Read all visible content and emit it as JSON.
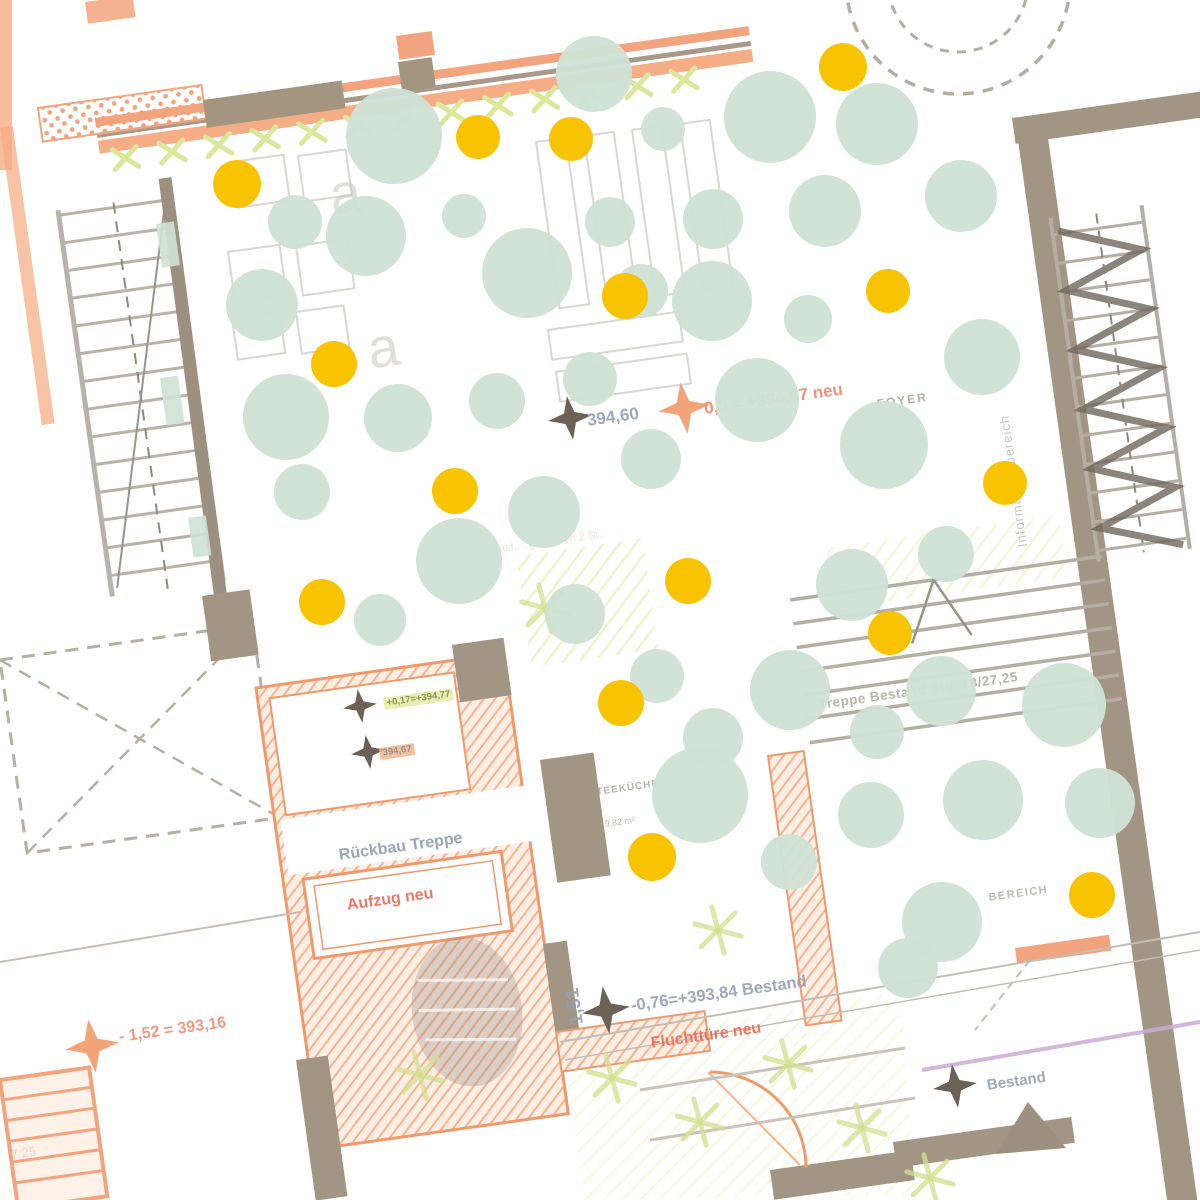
{
  "scene": {
    "description": "Architectural floor plan (rotated ~-8deg) with overlay of mint and yellow dots",
    "plan_rotation_deg": -8,
    "background": "#ffffff"
  },
  "colors": {
    "mint_bubble": "#cfe2d4",
    "yellow_bubble": "#f8c300",
    "wall_taupe": "#a29584",
    "wall_orange": "#f2a47e",
    "orange_hatch": "#f6b391",
    "lime": "#dbe79b",
    "blue_gray_text": "#93a0b4",
    "orange_text": "#f0876a",
    "red_orange_text": "#ea6a55",
    "warm_gray_text": "#a7a29a",
    "violet_line": "#cbaad6",
    "marker_dark": "#6b6157",
    "marker_orange": "#f2a478"
  },
  "labels": [
    {
      "id": "level-394-60",
      "text": "394,60",
      "x": 586,
      "y": 412,
      "size": 17,
      "color": "#93a0b4",
      "bold": true,
      "rot": -8,
      "op": 0.9
    },
    {
      "id": "level-394-67-neu",
      "text": "0,0 = +394,67 neu",
      "x": 703,
      "y": 400,
      "size": 17,
      "color": "#f0876a",
      "bold": true,
      "rot": -8,
      "op": 0.9
    },
    {
      "id": "room-foyer",
      "text": "FOYER",
      "x": 876,
      "y": 398,
      "size": 12,
      "color": "#a7a29a",
      "bold": true,
      "rot": -8,
      "ls": 2,
      "op": 0.85
    },
    {
      "id": "zone-informationsbereich",
      "text": "Informationsbereich",
      "x": 1016,
      "y": 548,
      "size": 13,
      "color": "#a7a29a",
      "rot": -98,
      "ls": 1,
      "op": 0.6
    },
    {
      "id": "note-rueckbau-treppe",
      "text": "Rückbau Treppe",
      "x": 338,
      "y": 848,
      "size": 16,
      "color": "#8e9db3",
      "bold": true,
      "rot": -8,
      "op": 0.9
    },
    {
      "id": "note-aufzug-neu",
      "text": "Aufzug neu",
      "x": 346,
      "y": 898,
      "size": 16,
      "color": "#ea6a55",
      "bold": true,
      "rot": -8,
      "op": 0.9
    },
    {
      "id": "level-394-77",
      "text": "+0,17=+394,77",
      "x": 383,
      "y": 698,
      "size": 9.5,
      "color": "#7d8746",
      "bold": true,
      "rot": -8,
      "bg": "#e7eeab",
      "op": 0.9
    },
    {
      "id": "level-394-67-chip",
      "text": "394,67",
      "x": 379,
      "y": 748,
      "size": 9.5,
      "color": "#857f76",
      "bold": true,
      "rot": -8,
      "bg": "#f3b48f",
      "op": 0.85
    },
    {
      "id": "room-teekueche",
      "text": "TEEKÜCHE",
      "x": 596,
      "y": 788,
      "size": 10,
      "color": "#a7a29a",
      "bold": true,
      "rot": -8,
      "ls": 1,
      "op": 0.8
    },
    {
      "id": "room-teekueche-area",
      "text": "9,82 m²",
      "x": 604,
      "y": 820,
      "size": 9,
      "color": "#a7a29a",
      "rot": -8,
      "op": 0.75
    },
    {
      "id": "note-treppe-bestand",
      "text": "Treppe Bestand Stg. 18/27,25",
      "x": 818,
      "y": 698,
      "size": 13.5,
      "color": "#a7a29a",
      "bold": true,
      "rot": -8,
      "ls": 0.5,
      "op": 0.8
    },
    {
      "id": "zone-bereich",
      "text": "BEREICH",
      "x": 988,
      "y": 893,
      "size": 11,
      "color": "#a7a29a",
      "bold": true,
      "rot": -8,
      "ls": 1.5,
      "op": 0.75
    },
    {
      "id": "level-393-84",
      "text": "-0,76=+393,84 Bestand",
      "x": 630,
      "y": 998,
      "size": 16.5,
      "color": "#93a0b4",
      "bold": true,
      "rot": -8,
      "op": 0.9
    },
    {
      "id": "dim-1-51",
      "text": "1,51",
      "x": 568,
      "y": 1026,
      "size": 19,
      "color": "#93a0b4",
      "bold": true,
      "rot": -98,
      "op": 0.9
    },
    {
      "id": "note-fluchttuere",
      "text": "Fluchttüre neu",
      "x": 650,
      "y": 1036,
      "size": 16,
      "color": "#ea6a55",
      "bold": true,
      "rot": -8,
      "op": 0.9
    },
    {
      "id": "level-393-16",
      "text": "- 1,52 = 393,16",
      "x": 118,
      "y": 1030,
      "size": 16,
      "color": "#f0876a",
      "bold": true,
      "rot": -8,
      "op": 0.85
    },
    {
      "id": "note-bestand",
      "text": "Bestand",
      "x": 986,
      "y": 1078,
      "size": 15,
      "color": "#93a0b4",
      "bold": true,
      "rot": -8,
      "op": 0.9
    },
    {
      "id": "faint-note",
      "text": "e Tast.. ..geblieben 2 St..",
      "x": 484,
      "y": 546,
      "size": 11,
      "color": "#f0876a",
      "rot": -8,
      "op": 0.3
    },
    {
      "id": "furniture-a-1",
      "text": "a",
      "x": 326,
      "y": 168,
      "size": 56,
      "color": "#c9c5bf",
      "rot": -8,
      "op": 0.55
    },
    {
      "id": "furniture-a-2",
      "text": "a",
      "x": 364,
      "y": 322,
      "size": 56,
      "color": "#c9c5bf",
      "rot": -8,
      "op": 0.55
    },
    {
      "id": "stair-dim",
      "text": "7 25",
      "x": 10,
      "y": 1148,
      "size": 13,
      "color": "#f0876a",
      "rot": -8,
      "op": 0.3
    }
  ],
  "markers": [
    {
      "x": 570,
      "y": 418,
      "color": "#6b6157",
      "size": 22
    },
    {
      "x": 684,
      "y": 408,
      "color": "#f2a478",
      "size": 26
    },
    {
      "x": 360,
      "y": 706,
      "color": "#6b6157",
      "size": 17
    },
    {
      "x": 368,
      "y": 752,
      "color": "#6b6157",
      "size": 17
    },
    {
      "x": 606,
      "y": 1010,
      "color": "#6b6157",
      "size": 24
    },
    {
      "x": 92,
      "y": 1046,
      "color": "#f2a478",
      "size": 27
    },
    {
      "x": 955,
      "y": 1086,
      "color": "#6b6157",
      "size": 22
    }
  ],
  "bubbles": {
    "mint": [
      [
        594,
        74,
        38
      ],
      [
        663,
        129,
        22
      ],
      [
        770,
        117,
        46
      ],
      [
        877,
        124,
        41
      ],
      [
        394,
        136,
        48
      ],
      [
        961,
        196,
        36
      ],
      [
        825,
        211,
        36
      ],
      [
        713,
        219,
        30
      ],
      [
        610,
        222,
        25
      ],
      [
        464,
        216,
        22
      ],
      [
        295,
        222,
        27
      ],
      [
        366,
        236,
        40
      ],
      [
        527,
        273,
        45
      ],
      [
        641,
        291,
        27
      ],
      [
        712,
        301,
        40
      ],
      [
        808,
        319,
        24
      ],
      [
        262,
        305,
        36
      ],
      [
        982,
        357,
        38
      ],
      [
        286,
        417,
        43
      ],
      [
        398,
        418,
        34
      ],
      [
        497,
        401,
        28
      ],
      [
        590,
        379,
        27
      ],
      [
        757,
        400,
        42
      ],
      [
        884,
        445,
        44
      ],
      [
        302,
        492,
        28
      ],
      [
        651,
        459,
        30
      ],
      [
        544,
        512,
        36
      ],
      [
        459,
        561,
        43
      ],
      [
        946,
        554,
        28
      ],
      [
        852,
        585,
        36
      ],
      [
        575,
        614,
        30
      ],
      [
        380,
        620,
        26
      ],
      [
        657,
        676,
        27
      ],
      [
        790,
        690,
        40
      ],
      [
        941,
        691,
        35
      ],
      [
        1064,
        705,
        42
      ],
      [
        713,
        738,
        30
      ],
      [
        877,
        732,
        27
      ],
      [
        700,
        795,
        48
      ],
      [
        983,
        800,
        40
      ],
      [
        1100,
        803,
        35
      ],
      [
        871,
        815,
        33
      ],
      [
        789,
        862,
        28
      ],
      [
        942,
        922,
        40
      ],
      [
        908,
        968,
        30
      ]
    ],
    "yellow": [
      [
        843,
        67,
        24
      ],
      [
        478,
        137,
        22
      ],
      [
        571,
        139,
        22
      ],
      [
        237,
        184,
        24
      ],
      [
        625,
        296,
        23
      ],
      [
        888,
        291,
        22
      ],
      [
        334,
        364,
        23
      ],
      [
        455,
        491,
        23
      ],
      [
        1005,
        483,
        22
      ],
      [
        322,
        602,
        23
      ],
      [
        688,
        581,
        23
      ],
      [
        890,
        633,
        22
      ],
      [
        621,
        703,
        23
      ],
      [
        652,
        857,
        24
      ],
      [
        1092,
        895,
        23
      ]
    ]
  }
}
